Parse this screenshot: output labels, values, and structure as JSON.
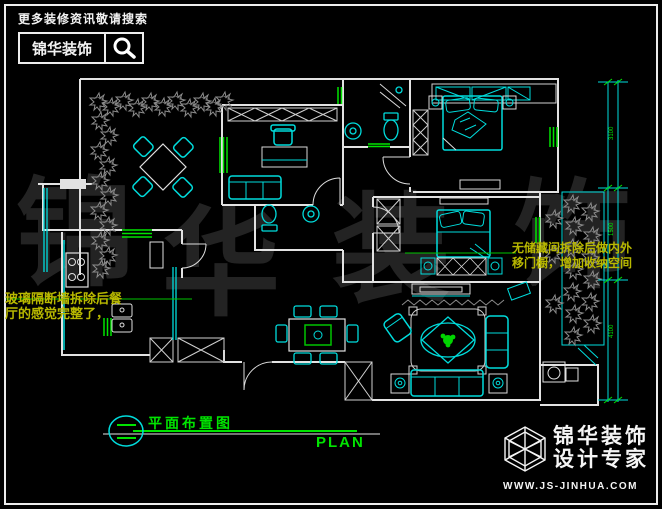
{
  "header": {
    "tagline": "更多装修资讯敬请搜索",
    "brand": "锦华装饰",
    "search_icon": "search-icon"
  },
  "title_block": {
    "title": "平面布置图",
    "plan_label": "PLAN",
    "section_marker_icon": "section-marker-icon"
  },
  "footer_logo": {
    "brand": "锦华装饰",
    "subtitle": "设计专家",
    "website": "WWW.JS-JINHUA.COM",
    "cube_icon": "cube-logo-icon"
  },
  "annotations": {
    "left_line1": "玻璃隔断墙拆除后餐",
    "left_line2": "厅的感觉完整了，",
    "right_line1": "无储藏间拆除后做内外",
    "right_line2": "移门橱，增加收纳空间"
  },
  "watermark": {
    "char1": "锦",
    "char2": "华",
    "char3": "装",
    "char4": "饰"
  },
  "dimensions": {
    "top": "3100",
    "middle": "1500",
    "bottom": "4100"
  },
  "colors": {
    "background": "#000000",
    "wall": "#e2e2e2",
    "furniture_cyan": "#00dcdc",
    "accent_green": "#00e400",
    "annotation_yellow": "#b8b800",
    "plants_gray": "#8c8c8c",
    "watermark_gray": "#232323"
  }
}
